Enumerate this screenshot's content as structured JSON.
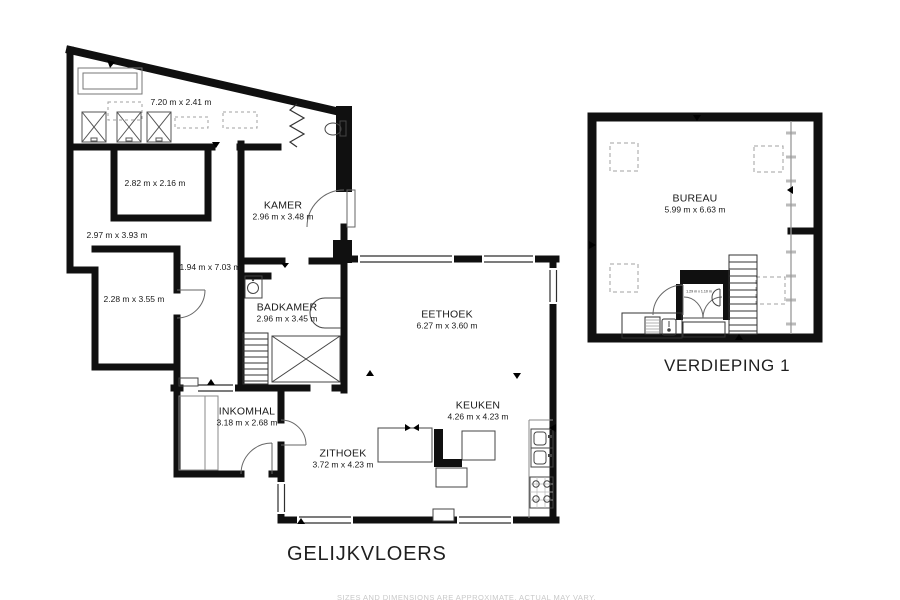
{
  "titles": {
    "ground": "GELIJKVLOERS",
    "first": "VERDIEPING 1"
  },
  "footer": {
    "note": "SIZES AND DIMENSIONS ARE APPROXIMATE, ACTUAL MAY VARY."
  },
  "ground": {
    "rooms": [
      {
        "dims": "7.20 m x 2.41 m"
      },
      {
        "dims": "2.82 m x 2.16 m"
      },
      {
        "dims": "2.97 m x 3.93 m"
      },
      {
        "dims": "2.28 m x 3.55 m"
      },
      {
        "dims": "1.94 m x 7.03 m"
      },
      {
        "name": "KAMER",
        "dims": "2.96 m x 3.48 m"
      },
      {
        "name": "BADKAMER",
        "dims": "2.96 m x 3.45 m"
      },
      {
        "name": "EETHOEK",
        "dims": "6.27 m x 3.60 m"
      },
      {
        "name": "KEUKEN",
        "dims": "4.26 m x 4.23 m"
      },
      {
        "name": "ZITHOEK",
        "dims": "3.72 m x 4.23 m"
      },
      {
        "name": "INKOMHAL",
        "dims": "3.18 m x 2.68 m"
      }
    ]
  },
  "first": {
    "rooms": [
      {
        "name": "BUREAU",
        "dims": "5.99 m x 6.63 m"
      },
      {
        "dims": "1.29 m x 1.10 m"
      }
    ]
  },
  "colors": {
    "wall": "#101010",
    "fixture": "#555555",
    "dashed": "#a0a0a0",
    "text": "#1a1a1a",
    "footer": "#c8c8c8"
  }
}
